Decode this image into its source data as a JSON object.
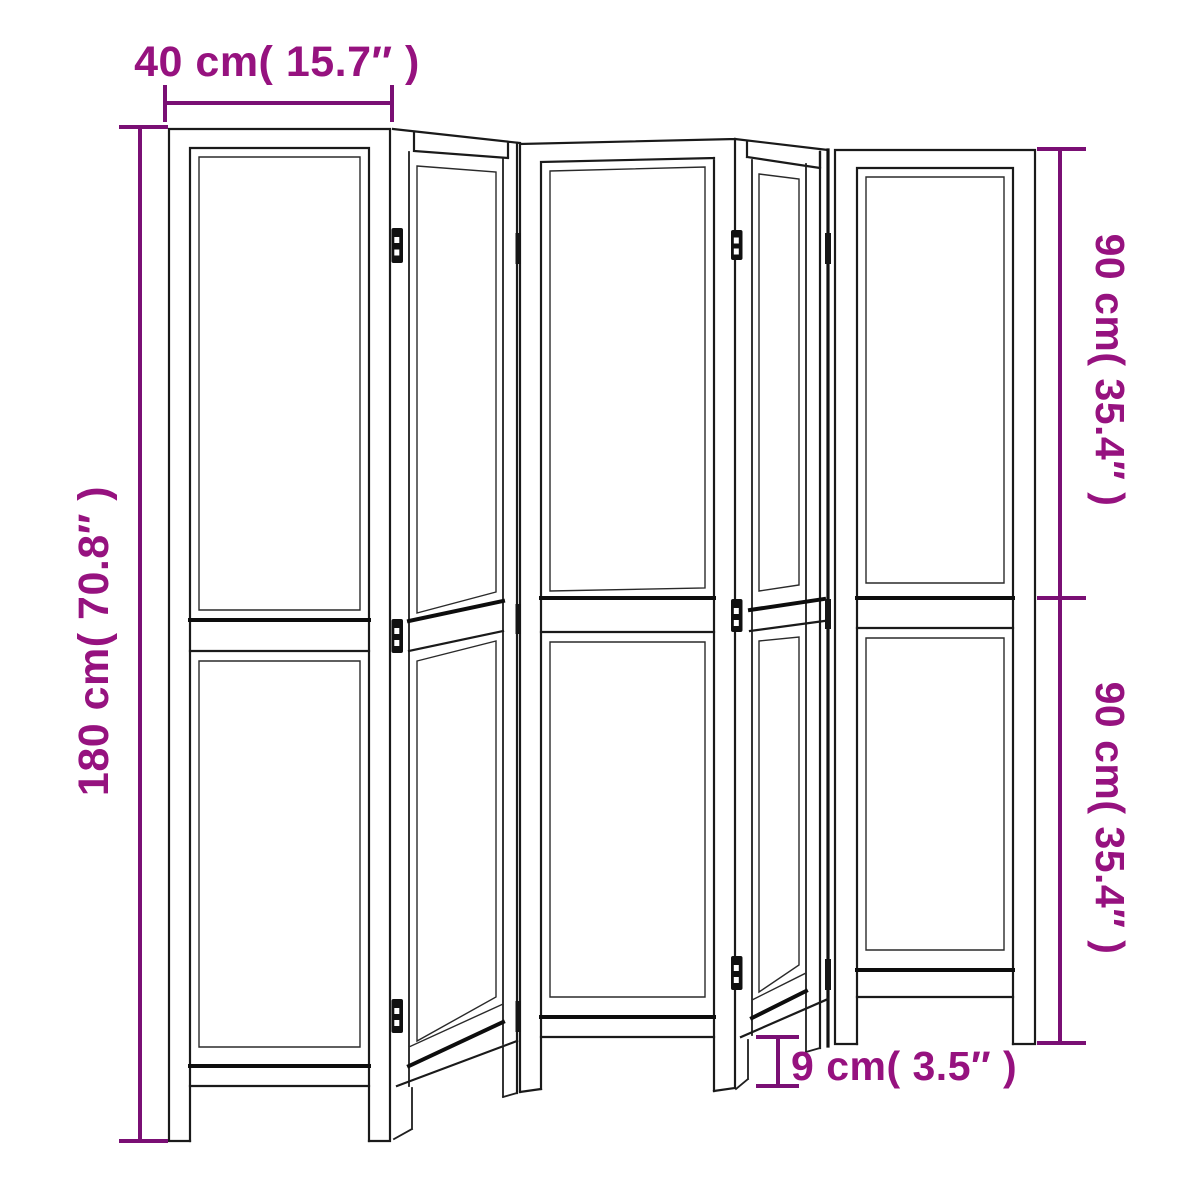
{
  "figure": {
    "title": "Room divider dimension diagram",
    "product": "Folding room divider with 5 hinged panels",
    "panel_count": 5,
    "view": "black line drawing with purple dimension annotations"
  },
  "dimensions": {
    "panel_width": {
      "cm": "40",
      "inch": "15.7",
      "label": "40 cm( 15.7″ )"
    },
    "total_height": {
      "cm": "180",
      "inch": "70.8",
      "label": "180 cm( 70.8″ )"
    },
    "upper_section_height": {
      "cm": "90",
      "inch": "35.4",
      "label": "90 cm( 35.4″ )"
    },
    "lower_section_height": {
      "cm": "90",
      "inch": "35.4",
      "label": "90 cm( 35.4″ )"
    },
    "leg_height": {
      "cm": "9",
      "inch": "3.5",
      "label": "9 cm( 3.5″ )"
    }
  },
  "colors": {
    "dimension_line": "#7A0F74",
    "dimension_text": "#96127F",
    "drawing_line": "#1a1a1a",
    "background": "#ffffff"
  }
}
